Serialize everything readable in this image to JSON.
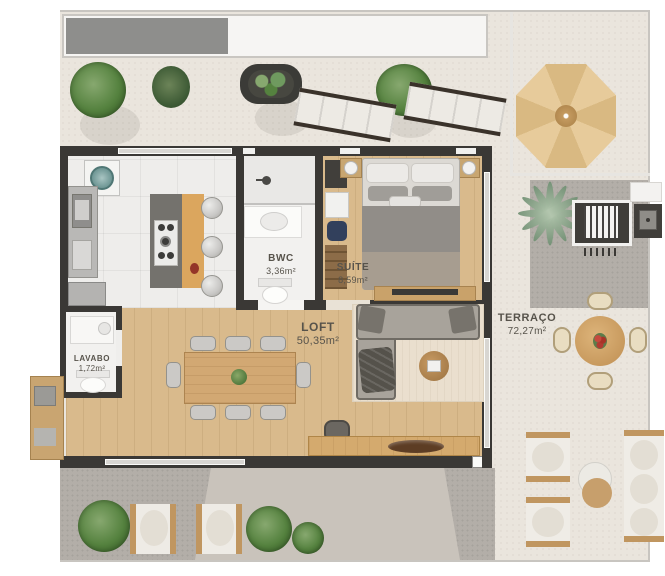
{
  "plan": {
    "type": "residential-floor-plan",
    "rooms": [
      {
        "name": "BWC",
        "area": "3,36m²"
      },
      {
        "name": "SUÍTE",
        "area": "8,59m²"
      },
      {
        "name": "LOFT",
        "area": "50,35m²"
      },
      {
        "name": "TERRAÇO",
        "area": "72,27m²"
      },
      {
        "name": "LAVABO",
        "area": "1,72m²"
      }
    ],
    "palette": {
      "wall": "#3a3835",
      "wood_floor": "#d9ba8c",
      "kitchen_tile": "#eeedeb",
      "terrace_floor": "#eae5dd",
      "concrete": "#b3aea8",
      "island_wood": "#dba65e",
      "umbrella": "#e2c092",
      "plant_green": "#4e7a42",
      "label_text": "#57534b"
    }
  }
}
